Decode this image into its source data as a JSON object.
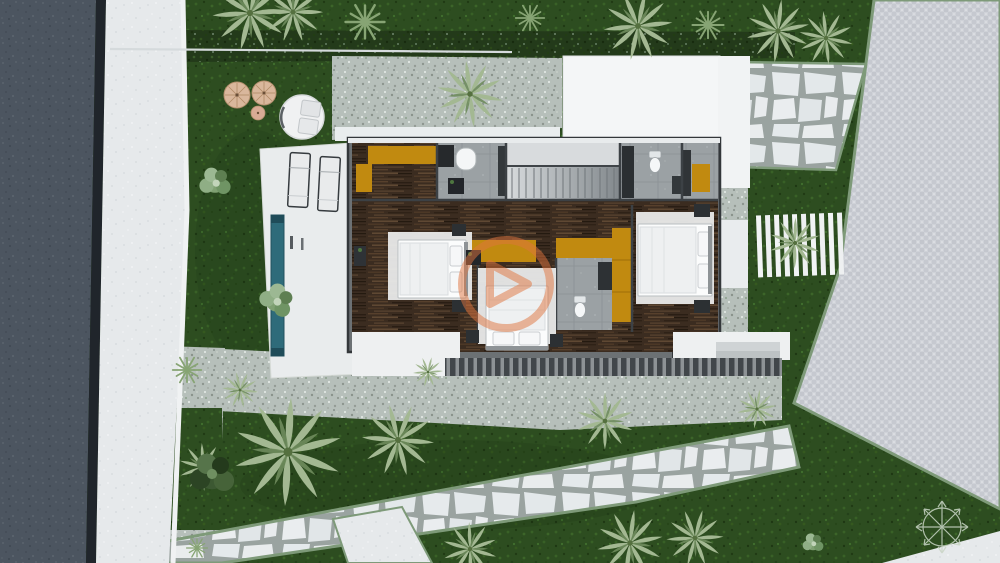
{
  "scene": {
    "type": "architectural-top-view-render",
    "description": "Aerial 3D render of a modern single-storey villa site plan with garden, lap pool, stone paths and driveway"
  },
  "labels": {
    "road": "asphalt road",
    "sidewalk": "sidewalk",
    "lawn": "garden lawn",
    "hedge": "hedge row",
    "gravel": "gravel bed",
    "stone_path": "flagstone path",
    "driveway": "paved driveway",
    "house": "villa floor plan",
    "roof": "white flat roof",
    "pool": "lap pool",
    "terrace": "pool terrace",
    "loungers": "sun loungers",
    "parasols": "straw parasols",
    "daybed": "round daybed",
    "slat_deck": "white louvre deck",
    "pergola": "dark pergola slats",
    "compass": "compass rose",
    "watermark": "brand watermark"
  },
  "house": {
    "rooms": [
      "bedroom-left",
      "bedroom-center",
      "bedroom-right",
      "bathroom-left",
      "bathroom-right",
      "bathroom-ensuite",
      "stair-hall",
      "corridor"
    ],
    "furniture": [
      "double-bed",
      "double-bed",
      "double-bed",
      "orange-wardrobe-L",
      "orange-wardrobe-band",
      "orange-wardrobe-band",
      "orange-wardrobe-tall",
      "orange-wardrobe-corner",
      "staircase",
      "toilet",
      "toilet",
      "bathtub",
      "nightstands"
    ],
    "bed_count": 3,
    "toilet_count": 2,
    "wardrobe_count": 5
  },
  "exterior": {
    "lounger_count": 2,
    "parasol_count": 3,
    "palm_count": 16,
    "bush_count": 6
  },
  "palette": {
    "road": "#4c5560",
    "curb": "#20252b",
    "sidewalk": "#e6e9eb",
    "boundary_white": "#f0f2f3",
    "grass": "#2d4d20",
    "hedge_dark": "#233a1a",
    "hedge_border": "#7e9a79",
    "gravel": "#b6bfba",
    "flagstone": "#e7ebed",
    "driveway": "#cfd2d8",
    "house_wall": "#6c7174",
    "wall_dark": "#393e42",
    "roof_white": "#f4f6f7",
    "walkway_white": "#eef0f1",
    "wood_floor": "#3b2c20",
    "bath_tile": "#9ba1a4",
    "closet_orange": "#c18a10",
    "pool_teal": "#2e6b7a",
    "bed_white": "#f0f1f2",
    "furniture_dark": "#2c3033",
    "umbrella_tan": "#d9b79c",
    "daybed_white": "#f0f1f2",
    "watermark_orange": "#e0743e",
    "compass_line": "#c9d5c5",
    "slat_dark": "#41464a"
  }
}
